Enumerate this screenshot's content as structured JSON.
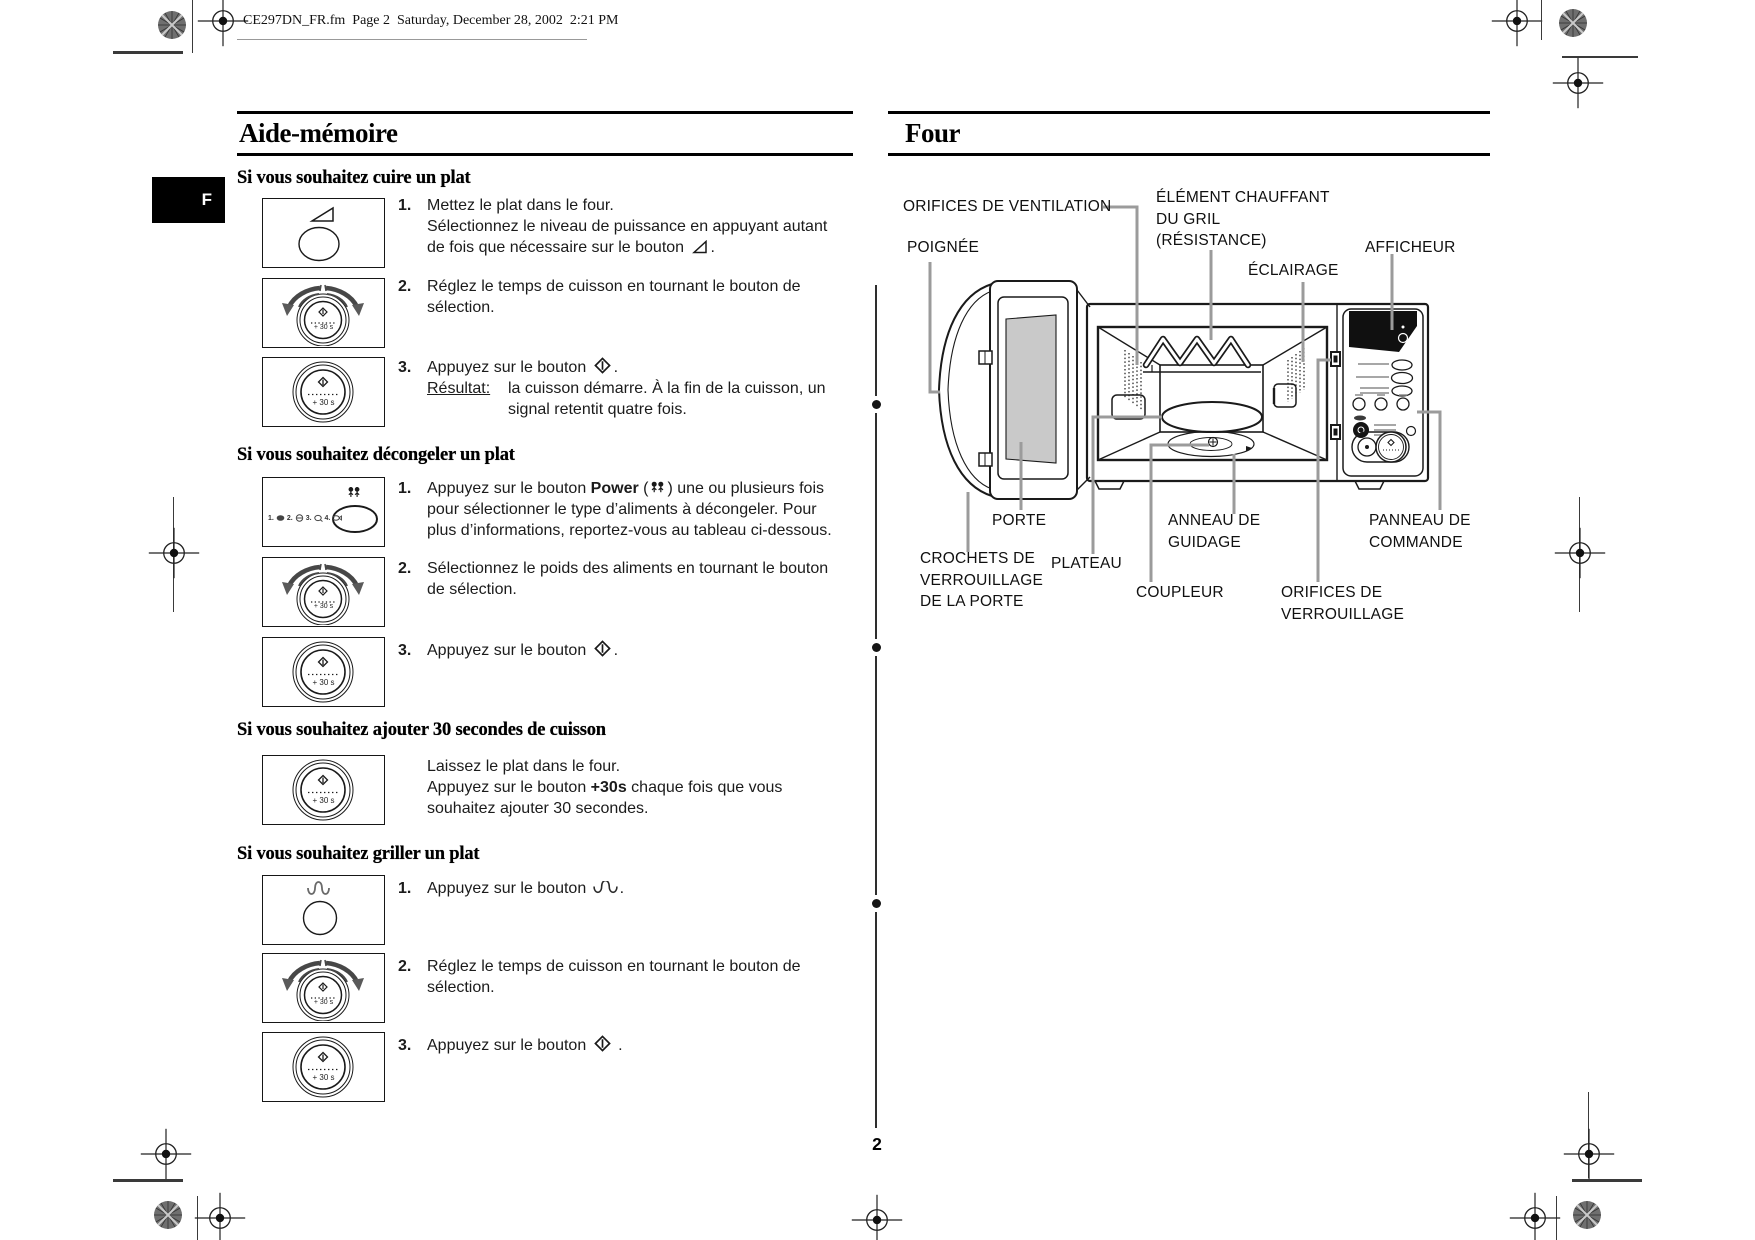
{
  "header": {
    "text": "CE297DN_FR.fm  Page 2  Saturday, December 28, 2002  2:21 PM"
  },
  "tab": {
    "label": "F"
  },
  "footer": {
    "page_number": "2"
  },
  "left": {
    "title": "Aide-mémoire",
    "knob_label": "+ 30 s",
    "defrost_nums": {
      "n1": "1.",
      "n2": "2.",
      "n3": "3.",
      "n4": "4."
    },
    "cuire": {
      "heading": "Si vous souhaitez cuire un plat",
      "s1": {
        "num": "1.",
        "l1": "Mettez le plat dans le four.",
        "l2": "Sélectionnez le niveau de puissance en appuyant autant",
        "l3": "de fois que nécessaire sur le bouton ",
        "l3end": "."
      },
      "s2": {
        "num": "2.",
        "l1": "Réglez le temps de cuisson en tournant le bouton de",
        "l2": "sélection."
      },
      "s3": {
        "num": "3.",
        "l1": "Appuyez sur le bouton ",
        "l1end": ".",
        "result_label": "Résultat:",
        "r1": "la cuisson démarre. À la fin de la cuisson, un",
        "r2": "signal retentit quatre fois."
      }
    },
    "decongeler": {
      "heading": "Si vous souhaitez décongeler un plat",
      "s1": {
        "num": "1.",
        "l1a": "Appuyez sur le bouton ",
        "l1b": "Power",
        "l1c": " (",
        "l1d": ") une ou plusieurs fois",
        "l2": "pour sélectionner le type d’aliments à décongeler. Pour",
        "l3": "plus d’informations, reportez-vous au tableau ci-dessous."
      },
      "s2": {
        "num": "2.",
        "l1": "Sélectionnez le poids des aliments en tournant le bouton",
        "l2": "de sélection."
      },
      "s3": {
        "num": "3.",
        "l1": "Appuyez sur le bouton ",
        "l1end": "."
      }
    },
    "ajouter": {
      "heading": "Si vous souhaitez ajouter 30 secondes de cuisson",
      "l1": "Laissez le plat dans le four.",
      "l2a": "Appuyez sur le bouton ",
      "l2b": "+30s",
      "l2c": " chaque fois que vous",
      "l3": "souhaitez ajouter 30 secondes."
    },
    "griller": {
      "heading": "Si vous souhaitez griller un plat",
      "s1": {
        "num": "1.",
        "l1": "Appuyez sur le bouton ",
        "l1end": "."
      },
      "s2": {
        "num": "2.",
        "l1": "Réglez le temps de cuisson en tournant le bouton de",
        "l2": "sélection."
      },
      "s3": {
        "num": "3.",
        "l1": "Appuyez sur le bouton ",
        "l1end": " ."
      }
    }
  },
  "right": {
    "title": "Four",
    "labels": {
      "ventilation": "ORIFICES DE VENTILATION",
      "element1": "ÉLÉMENT CHAUFFANT",
      "element2": "DU GRIL",
      "element3": "(RÉSISTANCE)",
      "poignee": "POIGNÉE",
      "eclairage": "ÉCLAIRAGE",
      "afficheur": "AFFICHEUR",
      "porte": "PORTE",
      "plateau": "PLATEAU",
      "anneau1": "ANNEAU DE",
      "anneau2": "GUIDAGE",
      "coupleur": "COUPLEUR",
      "crochets1": "CROCHETS DE",
      "crochets2": "VERROUILLAGE",
      "crochets3": "DE LA PORTE",
      "orifices1": "ORIFICES DE",
      "orifices2": "VERROUILLAGE",
      "panneau1": "PANNEAU DE",
      "panneau2": "COMMANDE"
    }
  }
}
